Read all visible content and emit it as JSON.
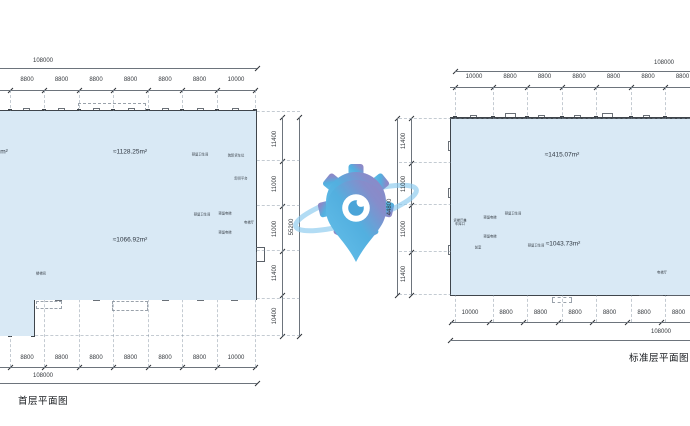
{
  "drawing": {
    "left_plan": {
      "title": "首层平面图",
      "areas": {
        "upper": "≈1128.25m²",
        "lower": "≈1066.92m²",
        "edge_partial": "m²"
      },
      "dims": {
        "top": {
          "total": "108000",
          "segments": [
            "8800",
            "8800",
            "8800",
            "8800",
            "8800",
            "8800",
            "10000"
          ]
        },
        "bottom": {
          "total": "108000",
          "segments": [
            "8800",
            "8800",
            "8800",
            "8800",
            "8800",
            "8800",
            "10000"
          ]
        },
        "right": {
          "total": "55200",
          "segments": [
            "11400",
            "11000",
            "11000",
            "11400",
            "10400"
          ]
        }
      },
      "rooms": {
        "reserved_toilet_upper": "预留卫生间",
        "truck_bays": "装卸货车位",
        "unloading_platform": "卸货平台",
        "reserved_elevator_1": "预留电梯",
        "reserved_elevator_2": "预留电梯",
        "elevator_hall": "电梯厅",
        "reserved_toilet_lower": "预留卫生间",
        "stair_core": "楼梯间"
      }
    },
    "right_plan": {
      "title": "标准层平面图",
      "areas": {
        "upper": "≈1415.07m²",
        "lower": "≈1043.73m²"
      },
      "dims": {
        "top": {
          "total": "108000",
          "segments": [
            "10000",
            "8800",
            "8800",
            "8800",
            "8800",
            "8800",
            "8800"
          ]
        },
        "bottom": {
          "total": "108000",
          "segments": [
            "10000",
            "8800",
            "8800",
            "8800",
            "8800",
            "8800",
            "8800"
          ]
        },
        "left": {
          "total": "44800",
          "segments": [
            "11400",
            "11000",
            "11000",
            "11400"
          ]
        }
      },
      "rooms": {
        "freight_hall_line1": "货梯厅兼",
        "freight_hall_line2": "车库口",
        "reserved_elevator_1": "预留电梯",
        "reserved_elevator_2": "预留电梯",
        "reserved_toilet_upper": "预留卫生间",
        "ante_room": "前室",
        "reserved_toilet_lower": "预留卫生间",
        "elevator_hall": "电梯厅"
      }
    }
  },
  "watermark": {
    "name": "gear-location-pin-logo",
    "colors": {
      "blue": "#46aadd",
      "light_blue": "#5cbdea",
      "purple": "#8d7dbd",
      "swoosh": "#8ccbee",
      "dot": "#3d9ed6"
    }
  },
  "colors": {
    "floor_fill": "#d9e9f5",
    "wall": "#3f454b",
    "dimension_text": "#33373c",
    "grid": "#7d8c9b"
  }
}
